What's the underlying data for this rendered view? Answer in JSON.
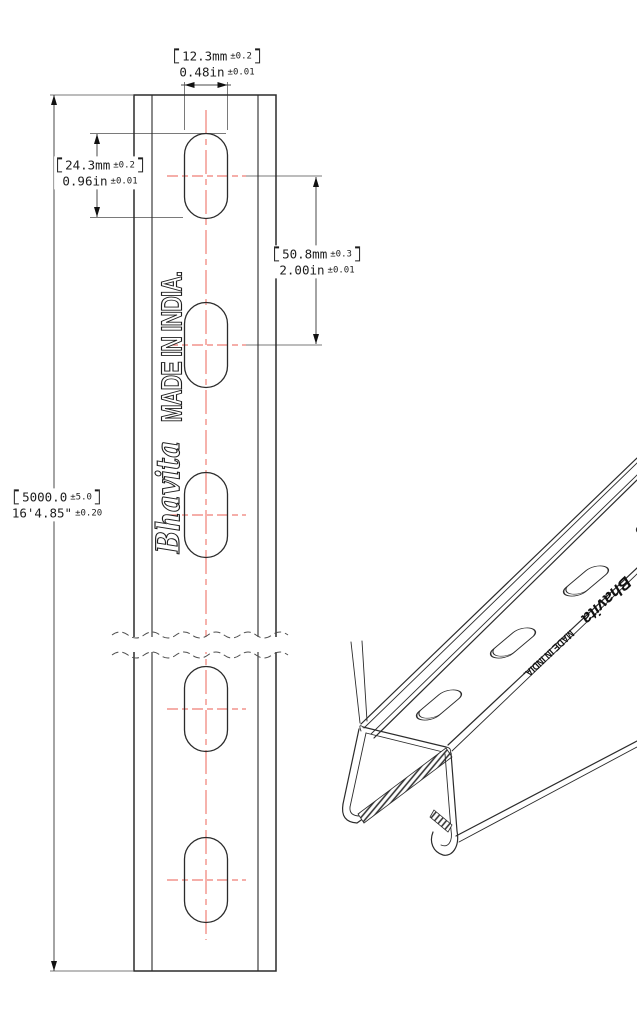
{
  "drawing": {
    "dims": {
      "slot_width": {
        "metric": "12.3mm",
        "metric_tol": "±0.2",
        "imperial": "0.48in",
        "imperial_tol": "±0.01"
      },
      "slot_length": {
        "metric": "24.3mm",
        "metric_tol": "±0.2",
        "imperial": "0.96in",
        "imperial_tol": "±0.01"
      },
      "slot_spacing": {
        "metric": "50.8mm",
        "metric_tol": "±0.3",
        "imperial": "2.00in",
        "imperial_tol": "±0.01"
      },
      "overall_length": {
        "metric": "5000.0",
        "metric_tol": "±5.0",
        "imperial": "16'4.85\"",
        "imperial_tol": "±0.20"
      }
    },
    "branding": {
      "brand": "Bhavita",
      "origin": "MADE IN INDIA."
    },
    "colors": {
      "line": "#2b2b2b",
      "centerline_red": "#ef7e76",
      "extension_gray": "#7a7a7a"
    }
  }
}
